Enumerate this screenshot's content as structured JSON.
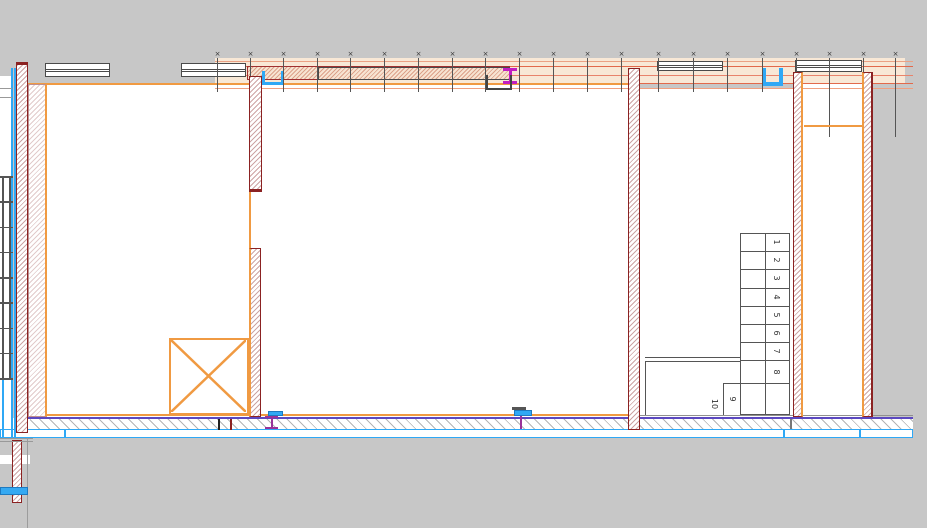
{
  "drawing": {
    "kind": "architectural floor plan section (CAD canvas)",
    "background": "#C7C7C7",
    "palette": {
      "wall_outline_dark_red": "#8B2222",
      "finish_orange": "#F09A42",
      "overlay_red": "#E2694B",
      "plumbing_blue": "#2FA8F5",
      "axis_violet": "#5B48C0",
      "steel_magenta": "#C11FC1",
      "line_gray": "#555555"
    }
  },
  "top_band": {
    "tick_glyph": "×",
    "tick_xs": [
      217,
      250,
      283,
      317,
      350,
      384,
      418,
      452,
      485,
      519,
      553,
      587,
      621,
      658,
      693,
      727,
      762,
      796,
      829,
      863,
      895
    ],
    "long_tick_xs": [
      829,
      895
    ]
  },
  "stairs": {
    "steps": [
      "1",
      "2",
      "3",
      "4",
      "5",
      "6",
      "7",
      "8"
    ],
    "winders": [
      "10",
      "9"
    ]
  },
  "ladder": {
    "rung_count": 9
  },
  "blue_band_segments": [
    [
      0,
      65
    ],
    [
      65,
      719
    ],
    [
      784,
      76
    ],
    [
      860,
      53
    ]
  ]
}
